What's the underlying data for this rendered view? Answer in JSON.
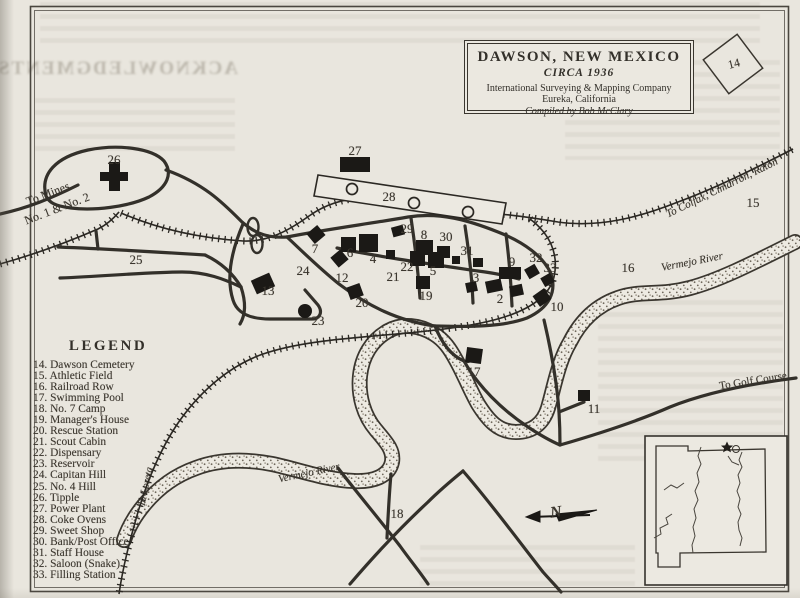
{
  "title_box": {
    "name": "DAWSON, NEW MEXICO",
    "circa": "CIRCA 1936",
    "company": "International Surveying & Mapping Company",
    "city": "Eureka, California",
    "compiled": "Compiled by Bob McClary"
  },
  "legend": {
    "title": "LEGEND",
    "items": [
      {
        "n": 14,
        "label": "Dawson Cemetery"
      },
      {
        "n": 15,
        "label": "Athletic Field"
      },
      {
        "n": 16,
        "label": "Railroad Row"
      },
      {
        "n": 17,
        "label": "Swimming Pool"
      },
      {
        "n": 18,
        "label": "No. 7 Camp"
      },
      {
        "n": 19,
        "label": "Manager's House"
      },
      {
        "n": 20,
        "label": "Rescue Station"
      },
      {
        "n": 21,
        "label": "Scout Cabin"
      },
      {
        "n": 22,
        "label": "Dispensary"
      },
      {
        "n": 23,
        "label": "Reservoir"
      },
      {
        "n": 24,
        "label": "Capitan Hill"
      },
      {
        "n": 25,
        "label": "No. 4 Hill"
      },
      {
        "n": 26,
        "label": "Tipple"
      },
      {
        "n": 27,
        "label": "Power Plant"
      },
      {
        "n": 28,
        "label": "Coke Ovens"
      },
      {
        "n": 29,
        "label": "Sweet Shop"
      },
      {
        "n": 30,
        "label": "Bank/Post Office"
      },
      {
        "n": 31,
        "label": "Staff House"
      },
      {
        "n": 32,
        "label": "Saloon (Snake)"
      },
      {
        "n": 33,
        "label": "Filling Station"
      }
    ]
  },
  "bleed_text": "ACKNOWLEDGMENTS",
  "map": {
    "markers": [
      {
        "n": 2,
        "x": 500,
        "y": 299
      },
      {
        "n": 3,
        "x": 476,
        "y": 278
      },
      {
        "n": 4,
        "x": 373,
        "y": 259
      },
      {
        "n": 5,
        "x": 433,
        "y": 271
      },
      {
        "n": 6,
        "x": 350,
        "y": 253
      },
      {
        "n": 7,
        "x": 315,
        "y": 249
      },
      {
        "n": 8,
        "x": 424,
        "y": 235
      },
      {
        "n": 9,
        "x": 512,
        "y": 262
      },
      {
        "n": 10,
        "x": 557,
        "y": 307
      },
      {
        "n": 11,
        "x": 594,
        "y": 409
      },
      {
        "n": 12,
        "x": 342,
        "y": 278
      },
      {
        "n": 13,
        "x": 268,
        "y": 291
      },
      {
        "n": 15,
        "x": 753,
        "y": 203
      },
      {
        "n": 16,
        "x": 628,
        "y": 268
      },
      {
        "n": 17,
        "x": 474,
        "y": 372
      },
      {
        "n": 18,
        "x": 397,
        "y": 514
      },
      {
        "n": 19,
        "x": 426,
        "y": 296
      },
      {
        "n": 20,
        "x": 362,
        "y": 303
      },
      {
        "n": 21,
        "x": 393,
        "y": 277
      },
      {
        "n": 22,
        "x": 407,
        "y": 267
      },
      {
        "n": 23,
        "x": 318,
        "y": 321
      },
      {
        "n": 24,
        "x": 303,
        "y": 271
      },
      {
        "n": 25,
        "x": 136,
        "y": 260
      },
      {
        "n": 26,
        "x": 114,
        "y": 160
      },
      {
        "n": 27,
        "x": 355,
        "y": 151
      },
      {
        "n": 28,
        "x": 389,
        "y": 197
      },
      {
        "n": 29,
        "x": 407,
        "y": 229
      },
      {
        "n": 30,
        "x": 446,
        "y": 237
      },
      {
        "n": 31,
        "x": 467,
        "y": 251
      },
      {
        "n": 32,
        "x": 536,
        "y": 258
      },
      {
        "n": 33,
        "x": 550,
        "y": 268
      }
    ],
    "labels": [
      {
        "id": "to-mines-1",
        "text": "To Mines",
        "x": 48,
        "y": 194,
        "rot": -21,
        "size": 12,
        "i": 0,
        "b": 0
      },
      {
        "id": "to-mines-2",
        "text": "No. 1 & No. 2",
        "x": 57,
        "y": 209,
        "rot": -21,
        "size": 12,
        "i": 0,
        "b": 0
      },
      {
        "id": "to-colfax",
        "text": "To Colfax, Cimarron, Raton",
        "x": 722,
        "y": 188,
        "rot": -26,
        "size": 11,
        "i": 1,
        "b": 0
      },
      {
        "id": "vermejo-east",
        "text": "Vermejo River",
        "x": 692,
        "y": 262,
        "rot": -11,
        "size": 11,
        "i": 1,
        "b": 0
      },
      {
        "id": "vermejo-center",
        "text": "Vermejo River",
        "x": 309,
        "y": 473,
        "rot": -12,
        "size": 11,
        "i": 1,
        "b": 0
      },
      {
        "id": "to-golf-course",
        "text": "To Golf Course",
        "x": 753,
        "y": 381,
        "rot": -9,
        "size": 11,
        "i": 0,
        "b": 0
      },
      {
        "id": "to-loreta",
        "text": "To Loreta",
        "x": 146,
        "y": 487,
        "rot": -78,
        "size": 10.5,
        "i": 1,
        "b": 0
      },
      {
        "id": "cemetery-number",
        "text": "14",
        "x": 734,
        "y": 64,
        "rot": -14,
        "size": 12,
        "i": 0,
        "b": 0
      },
      {
        "id": "compass-n",
        "text": "N",
        "x": 556,
        "y": 513,
        "rot": -8,
        "size": 16,
        "i": 1,
        "b": 1
      }
    ]
  }
}
